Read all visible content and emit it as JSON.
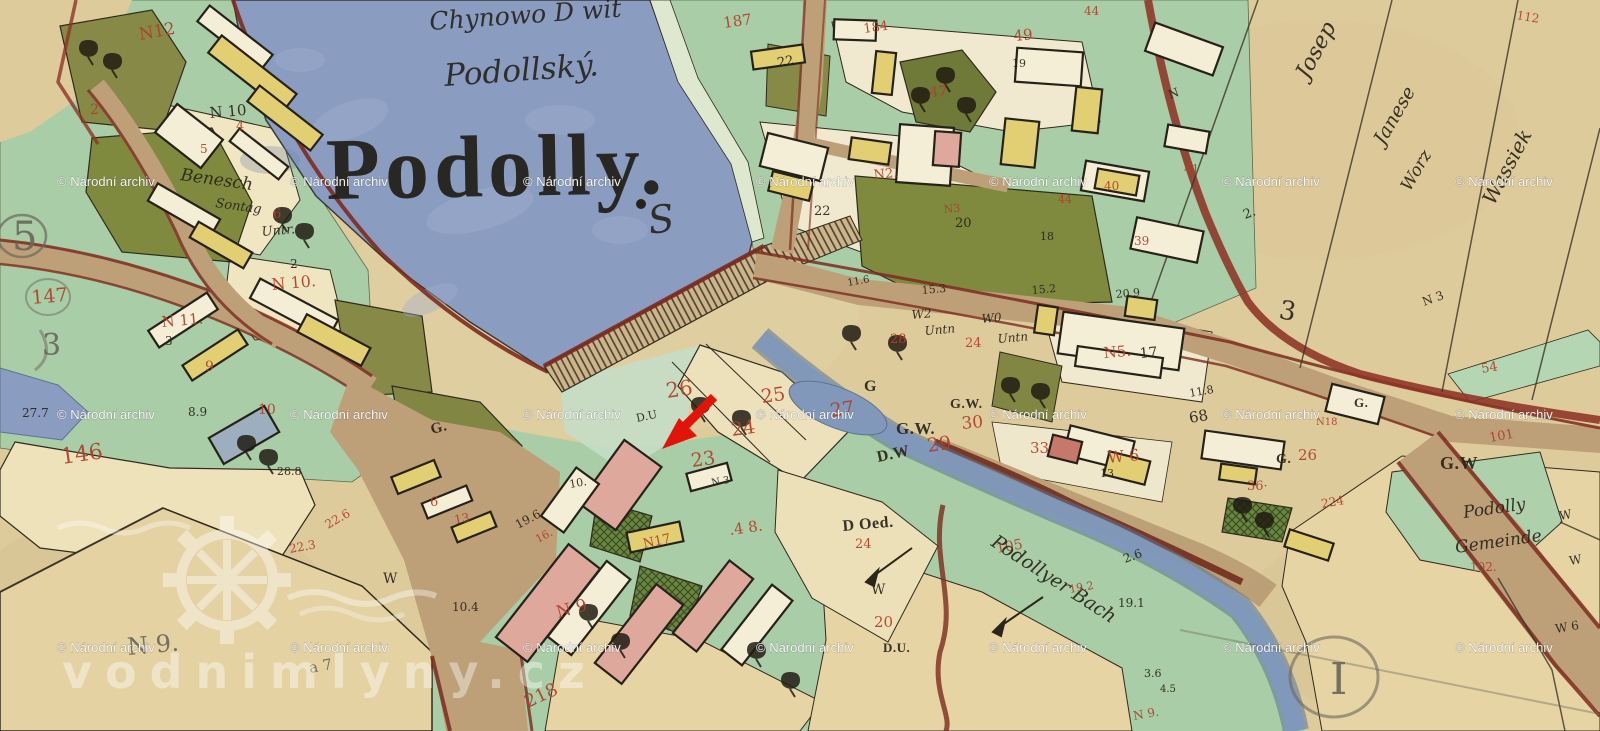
{
  "map": {
    "title": "Podolly.",
    "subtitle": "Podollský.",
    "top_note": "Chynowo D wit",
    "flourish": "S",
    "colors": {
      "red": "#b2402c",
      "ink": "#2b261a",
      "pencil": "#6c685c"
    },
    "labels": [
      {
        "t": "N12",
        "x": 140,
        "y": 40,
        "s": 17,
        "c": "red",
        "r": -10
      },
      {
        "t": "2",
        "x": 90,
        "y": 114,
        "s": 14,
        "c": "red"
      },
      {
        "t": "N 10",
        "x": 210,
        "y": 118,
        "s": 15,
        "c": "ink",
        "r": -5
      },
      {
        "t": "4",
        "x": 236,
        "y": 130,
        "s": 13,
        "c": "red"
      },
      {
        "t": "5",
        "x": 200,
        "y": 153,
        "s": 12,
        "c": "red"
      },
      {
        "t": "Benesch",
        "x": 180,
        "y": 180,
        "s": 17,
        "c": "ink",
        "f": "cursive",
        "r": 8
      },
      {
        "t": "Sontag",
        "x": 215,
        "y": 207,
        "s": 13,
        "c": "ink",
        "f": "cursive",
        "r": 8
      },
      {
        "t": "6",
        "x": 273,
        "y": 218,
        "s": 13,
        "c": "red"
      },
      {
        "t": "Untr.",
        "x": 262,
        "y": 236,
        "s": 13,
        "c": "ink",
        "f": "cursive",
        "r": -5
      },
      {
        "t": "5",
        "x": 12,
        "y": 250,
        "s": 40,
        "c": "pencil"
      },
      {
        "t": "147",
        "x": 32,
        "y": 304,
        "s": 19,
        "c": "red",
        "r": -5
      },
      {
        "t": "3",
        "x": 42,
        "y": 355,
        "s": 30,
        "c": "pencil"
      },
      {
        "t": "27.7",
        "x": 22,
        "y": 417,
        "s": 12,
        "c": "ink"
      },
      {
        "t": "146",
        "x": 62,
        "y": 464,
        "s": 22,
        "c": "red",
        "r": -8
      },
      {
        "t": "N 10.",
        "x": 272,
        "y": 290,
        "s": 16,
        "c": "red",
        "r": -5
      },
      {
        "t": "2",
        "x": 290,
        "y": 268,
        "s": 12,
        "c": "ink"
      },
      {
        "t": "N 11.",
        "x": 162,
        "y": 327,
        "s": 15,
        "c": "red",
        "r": -5
      },
      {
        "t": "3",
        "x": 165,
        "y": 345,
        "s": 12,
        "c": "ink"
      },
      {
        "t": "9",
        "x": 205,
        "y": 371,
        "s": 14,
        "c": "red"
      },
      {
        "t": "10",
        "x": 258,
        "y": 414,
        "s": 14,
        "c": "red"
      },
      {
        "t": "8.9",
        "x": 188,
        "y": 416,
        "s": 12,
        "c": "ink"
      },
      {
        "t": "28.8",
        "x": 277,
        "y": 475,
        "s": 11,
        "c": "ink"
      },
      {
        "t": "22.6",
        "x": 328,
        "y": 529,
        "s": 12,
        "c": "red",
        "r": -30
      },
      {
        "t": "22.3",
        "x": 290,
        "y": 553,
        "s": 12,
        "c": "red",
        "r": -10
      },
      {
        "t": "W",
        "x": 383,
        "y": 583,
        "s": 14,
        "c": "ink"
      },
      {
        "t": "10.4",
        "x": 452,
        "y": 611,
        "s": 12,
        "c": "ink"
      },
      {
        "t": "218",
        "x": 528,
        "y": 708,
        "s": 18,
        "c": "red",
        "r": -25
      },
      {
        "t": "N 9.",
        "x": 128,
        "y": 655,
        "s": 24,
        "c": "pencil",
        "r": -5
      },
      {
        "t": "a 7",
        "x": 310,
        "y": 673,
        "s": 15,
        "c": "pencil",
        "r": -10
      },
      {
        "t": "G.",
        "x": 432,
        "y": 434,
        "s": 15,
        "c": "ink",
        "f": "print",
        "r": -15
      },
      {
        "t": "6",
        "x": 430,
        "y": 506,
        "s": 13,
        "c": "red"
      },
      {
        "t": "13",
        "x": 455,
        "y": 524,
        "s": 12,
        "c": "red",
        "r": -10
      },
      {
        "t": "19.6",
        "x": 518,
        "y": 529,
        "s": 12,
        "c": "ink",
        "r": -28
      },
      {
        "t": "16.",
        "x": 538,
        "y": 543,
        "s": 11,
        "c": "red",
        "r": -28
      },
      {
        "t": "10.",
        "x": 570,
        "y": 488,
        "s": 11,
        "c": "ink",
        "r": -10
      },
      {
        "t": "D.U",
        "x": 637,
        "y": 422,
        "s": 11,
        "c": "ink",
        "r": -12
      },
      {
        "t": "26",
        "x": 667,
        "y": 398,
        "s": 21,
        "c": "red",
        "r": -8
      },
      {
        "t": "25",
        "x": 762,
        "y": 403,
        "s": 19,
        "c": "red",
        "r": -8
      },
      {
        "t": "24",
        "x": 732,
        "y": 436,
        "s": 19,
        "c": "red",
        "r": -8
      },
      {
        "t": "23",
        "x": 692,
        "y": 467,
        "s": 19,
        "c": "red",
        "r": -8
      },
      {
        "t": "N 3",
        "x": 712,
        "y": 486,
        "s": 10,
        "c": "ink",
        "r": -10
      },
      {
        "t": "27",
        "x": 831,
        "y": 417,
        "s": 19,
        "c": "red",
        "r": -8
      },
      {
        "t": "G.W.",
        "x": 896,
        "y": 434,
        "s": 17,
        "c": "ink",
        "f": "print"
      },
      {
        "t": "29",
        "x": 928,
        "y": 452,
        "s": 19,
        "c": "red",
        "r": -8
      },
      {
        "t": "D.W",
        "x": 878,
        "y": 462,
        "s": 16,
        "c": "ink",
        "f": "print",
        "r": -12
      },
      {
        "t": "G.W.",
        "x": 950,
        "y": 408,
        "s": 14,
        "c": "ink",
        "f": "print"
      },
      {
        "t": "30",
        "x": 962,
        "y": 429,
        "s": 17,
        "c": "red",
        "r": -5
      },
      {
        "t": "33",
        "x": 1030,
        "y": 453,
        "s": 15,
        "c": "red"
      },
      {
        "t": "W 6",
        "x": 1108,
        "y": 463,
        "s": 16,
        "c": "red",
        "r": -5
      },
      {
        "t": "13",
        "x": 1100,
        "y": 477,
        "s": 11,
        "c": "ink"
      },
      {
        "t": "N 9",
        "x": 558,
        "y": 618,
        "s": 17,
        "c": "red",
        "r": -15
      },
      {
        "t": "N17",
        "x": 644,
        "y": 548,
        "s": 13,
        "c": "red",
        "r": -12
      },
      {
        "t": ".4 8.",
        "x": 730,
        "y": 535,
        "s": 15,
        "c": "red",
        "r": -8
      },
      {
        "t": "187",
        "x": 724,
        "y": 28,
        "s": 15,
        "c": "red",
        "r": -8
      },
      {
        "t": "184",
        "x": 864,
        "y": 33,
        "s": 13,
        "c": "red",
        "r": -8
      },
      {
        "t": "22",
        "x": 778,
        "y": 67,
        "s": 13,
        "c": "ink",
        "r": -10
      },
      {
        "t": "49",
        "x": 1014,
        "y": 41,
        "s": 15,
        "c": "red",
        "r": -5
      },
      {
        "t": "19",
        "x": 1012,
        "y": 67,
        "s": 11,
        "c": "ink"
      },
      {
        "t": "47",
        "x": 930,
        "y": 97,
        "s": 14,
        "c": "red",
        "r": -5
      },
      {
        "t": "N2.",
        "x": 874,
        "y": 179,
        "s": 13,
        "c": "red",
        "r": -5
      },
      {
        "t": "22",
        "x": 814,
        "y": 215,
        "s": 13,
        "c": "ink"
      },
      {
        "t": "N3",
        "x": 944,
        "y": 213,
        "s": 11,
        "c": "red",
        "r": -5
      },
      {
        "t": "20",
        "x": 955,
        "y": 227,
        "s": 13,
        "c": "ink"
      },
      {
        "t": "18",
        "x": 1040,
        "y": 240,
        "s": 11,
        "c": "ink"
      },
      {
        "t": "44",
        "x": 1058,
        "y": 203,
        "s": 11,
        "c": "red"
      },
      {
        "t": "40",
        "x": 1104,
        "y": 190,
        "s": 12,
        "c": "red"
      },
      {
        "t": "39",
        "x": 1134,
        "y": 245,
        "s": 12,
        "c": "red"
      },
      {
        "t": "41",
        "x": 1184,
        "y": 173,
        "s": 12,
        "c": "red"
      },
      {
        "t": "44",
        "x": 1084,
        "y": 15,
        "s": 12,
        "c": "red"
      },
      {
        "t": "112",
        "x": 1516,
        "y": 19,
        "s": 12,
        "c": "red",
        "r": 10
      },
      {
        "t": "15.3",
        "x": 922,
        "y": 294,
        "s": 11,
        "c": "ink",
        "r": -5
      },
      {
        "t": "15.2",
        "x": 1032,
        "y": 294,
        "s": 11,
        "c": "ink",
        "r": -5
      },
      {
        "t": "20.9",
        "x": 1116,
        "y": 298,
        "s": 11,
        "c": "ink",
        "r": -5
      },
      {
        "t": "11.6",
        "x": 848,
        "y": 286,
        "s": 10,
        "c": "ink",
        "r": -10
      },
      {
        "t": "W2",
        "x": 912,
        "y": 319,
        "s": 12,
        "c": "ink",
        "f": "cursive",
        "r": -5
      },
      {
        "t": "Untn",
        "x": 925,
        "y": 335,
        "s": 12,
        "c": "ink",
        "f": "cursive",
        "r": -5
      },
      {
        "t": "W0",
        "x": 982,
        "y": 323,
        "s": 12,
        "c": "ink",
        "f": "cursive",
        "r": -5
      },
      {
        "t": "Untn",
        "x": 998,
        "y": 343,
        "s": 12,
        "c": "ink",
        "f": "cursive",
        "r": -5
      },
      {
        "t": "28",
        "x": 890,
        "y": 343,
        "s": 13,
        "c": "red"
      },
      {
        "t": "24",
        "x": 965,
        "y": 347,
        "s": 13,
        "c": "red"
      },
      {
        "t": "G",
        "x": 864,
        "y": 391,
        "s": 16,
        "c": "ink",
        "f": "print"
      },
      {
        "t": "N5.",
        "x": 1104,
        "y": 358,
        "s": 15,
        "c": "red",
        "r": -5
      },
      {
        "t": "17",
        "x": 1140,
        "y": 358,
        "s": 14,
        "c": "ink",
        "r": -5
      },
      {
        "t": "11.8",
        "x": 1190,
        "y": 397,
        "s": 11,
        "c": "ink",
        "r": -10
      },
      {
        "t": "68",
        "x": 1190,
        "y": 423,
        "s": 15,
        "c": "ink",
        "r": -10
      },
      {
        "t": "3",
        "x": 1278,
        "y": 318,
        "s": 26,
        "c": "ink",
        "r": 10
      },
      {
        "t": "Josep",
        "x": 1308,
        "y": 80,
        "s": 22,
        "c": "ink",
        "f": "cursive",
        "r": -62
      },
      {
        "t": "Janese",
        "x": 1384,
        "y": 146,
        "s": 19,
        "c": "ink",
        "f": "cursive",
        "r": -60
      },
      {
        "t": "Worz",
        "x": 1410,
        "y": 192,
        "s": 17,
        "c": "ink",
        "f": "cursive",
        "r": -60
      },
      {
        "t": "Wassiek",
        "x": 1494,
        "y": 206,
        "s": 20,
        "c": "ink",
        "f": "cursive",
        "r": -62
      },
      {
        "t": "N",
        "x": 1170,
        "y": 99,
        "s": 12,
        "c": "ink",
        "r": -20
      },
      {
        "t": "2.",
        "x": 1245,
        "y": 219,
        "s": 13,
        "c": "ink",
        "r": -20
      },
      {
        "t": "N 3",
        "x": 1424,
        "y": 306,
        "s": 12,
        "c": "ink",
        "r": -20
      },
      {
        "t": "54",
        "x": 1482,
        "y": 373,
        "s": 13,
        "c": "red",
        "r": -10
      },
      {
        "t": "101",
        "x": 1490,
        "y": 442,
        "s": 13,
        "c": "red",
        "r": -10
      },
      {
        "t": "G.W",
        "x": 1440,
        "y": 469,
        "s": 18,
        "c": "ink",
        "f": "print"
      },
      {
        "t": "Podolly",
        "x": 1464,
        "y": 518,
        "s": 17,
        "c": "ink",
        "f": "cursive",
        "r": -8
      },
      {
        "t": "Gemeinde",
        "x": 1456,
        "y": 553,
        "s": 17,
        "c": "ink",
        "f": "cursive",
        "r": -8
      },
      {
        "t": "102.",
        "x": 1470,
        "y": 571,
        "s": 12,
        "c": "red"
      },
      {
        "t": "W",
        "x": 1560,
        "y": 520,
        "s": 12,
        "c": "ink",
        "r": -10
      },
      {
        "t": "W",
        "x": 1570,
        "y": 565,
        "s": 12,
        "c": "ink",
        "r": -10
      },
      {
        "t": "W 6",
        "x": 1556,
        "y": 633,
        "s": 12,
        "c": "ink",
        "r": -10
      },
      {
        "t": "I",
        "x": 1330,
        "y": 694,
        "s": 44,
        "c": "pencil"
      },
      {
        "t": "G.",
        "x": 1276,
        "y": 463,
        "s": 14,
        "c": "ink",
        "f": "print"
      },
      {
        "t": "26",
        "x": 1298,
        "y": 460,
        "s": 15,
        "c": "red"
      },
      {
        "t": "36·",
        "x": 1247,
        "y": 490,
        "s": 13,
        "c": "red"
      },
      {
        "t": "224",
        "x": 1322,
        "y": 508,
        "s": 12,
        "c": "red",
        "r": -10
      },
      {
        "t": "G.",
        "x": 1354,
        "y": 407,
        "s": 13,
        "c": "ink",
        "f": "print"
      },
      {
        "t": "N18",
        "x": 1316,
        "y": 425,
        "s": 10,
        "c": "red"
      },
      {
        "t": "D Oed.",
        "x": 843,
        "y": 531,
        "s": 16,
        "c": "ink",
        "f": "print",
        "r": -5
      },
      {
        "t": "24",
        "x": 855,
        "y": 548,
        "s": 13,
        "c": "red"
      },
      {
        "t": "W",
        "x": 871,
        "y": 594,
        "s": 14,
        "c": "ink"
      },
      {
        "t": "20",
        "x": 874,
        "y": 627,
        "s": 15,
        "c": "red"
      },
      {
        "t": "D.U.",
        "x": 883,
        "y": 652,
        "s": 13,
        "c": "ink",
        "f": "print"
      },
      {
        "t": "105",
        "x": 997,
        "y": 553,
        "s": 14,
        "c": "red",
        "r": -10
      },
      {
        "t": "Podollyer Bach",
        "x": 990,
        "y": 545,
        "s": 19,
        "c": "ink",
        "f": "cursive",
        "r": 33
      },
      {
        "t": "2.6",
        "x": 1125,
        "y": 563,
        "s": 12,
        "c": "ink",
        "r": -20
      },
      {
        "t": "19.2",
        "x": 1070,
        "y": 593,
        "s": 11,
        "c": "red",
        "r": -10
      },
      {
        "t": "19.1",
        "x": 1118,
        "y": 607,
        "s": 12,
        "c": "ink"
      },
      {
        "t": "3.6",
        "x": 1144,
        "y": 677,
        "s": 11,
        "c": "ink"
      },
      {
        "t": "4.5",
        "x": 1160,
        "y": 692,
        "s": 10,
        "c": "ink"
      },
      {
        "t": "N 9.",
        "x": 1134,
        "y": 720,
        "s": 12,
        "c": "red",
        "r": -10
      }
    ]
  },
  "annotation": {
    "arrow_color": "#e01408"
  },
  "watermarks": {
    "archive_text": "© Národní archiv",
    "logo_text": "vodnimlyny.cz",
    "cols": [
      57,
      290,
      523,
      756,
      989,
      1222,
      1455
    ],
    "rows": [
      186,
      419,
      652
    ]
  }
}
